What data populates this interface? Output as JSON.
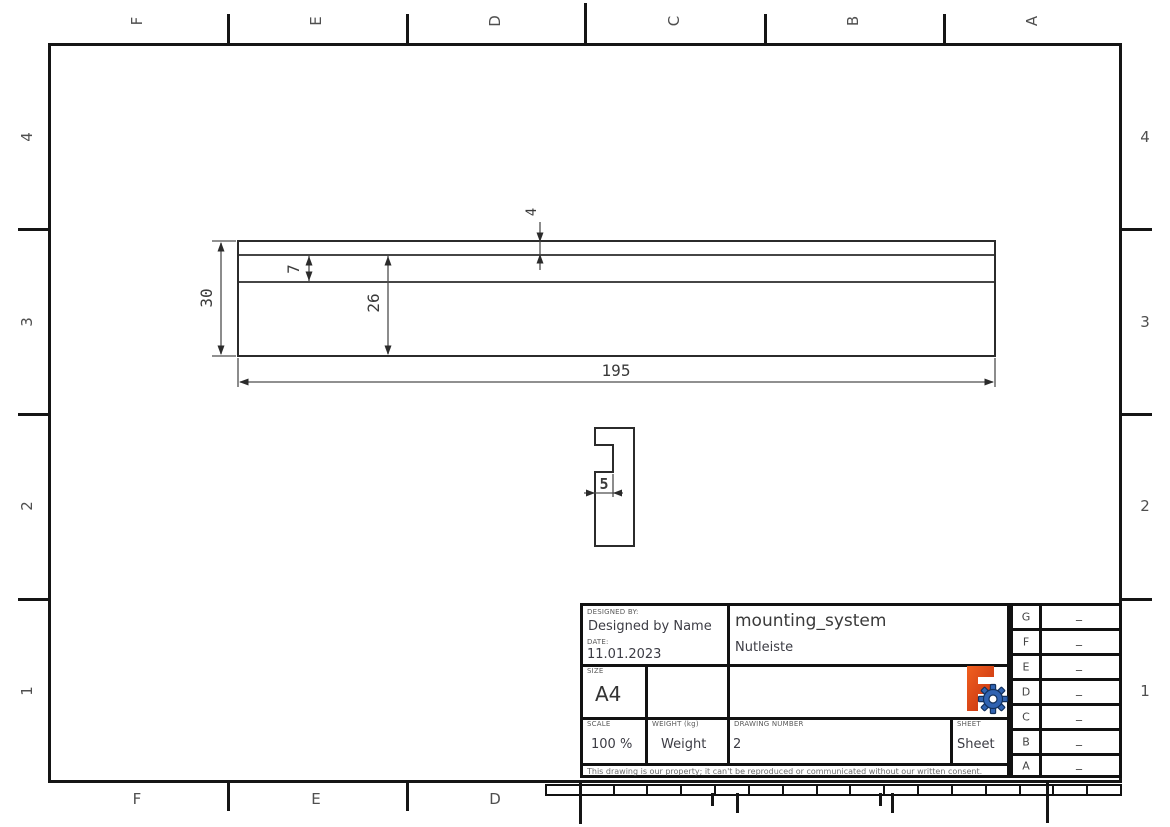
{
  "sheet": {
    "background": "#ffffff",
    "frame_color": "#151515",
    "format": "A4 landscape technical drawing"
  },
  "border": {
    "top_letters": [
      "F",
      "E",
      "D",
      "C",
      "B",
      "A"
    ],
    "bottom_letters": [
      "F",
      "E",
      "D"
    ],
    "left_numbers": [
      "4",
      "3",
      "2",
      "1"
    ],
    "right_numbers": [
      "4",
      "3",
      "2",
      "1"
    ]
  },
  "drawing": {
    "dims": {
      "length": "195",
      "total_height": "30",
      "inner_height": "26",
      "groove_height": "7",
      "top_lip": "4",
      "slot_width": "5"
    }
  },
  "title_block": {
    "designed_by_label": "DESIGNED BY:",
    "designed_by": "Designed by Name",
    "date_label": "DATE:",
    "date": "11.01.2023",
    "size_label": "SIZE",
    "size": "A4",
    "title": "mounting_system",
    "subtitle": "Nutleiste",
    "scale_label": "SCALE",
    "scale": "100 %",
    "weight_label": "WEIGHT (kg)",
    "weight": "Weight",
    "drawing_number_label": "DRAWING NUMBER",
    "drawing_number": "2",
    "sheet_label": "SHEET",
    "sheet": "Sheet",
    "disclaimer": "This drawing is our property; it can't be reproduced or communicated without our written consent.",
    "logo_colors": {
      "f_orange": "#e8481d",
      "f_red": "#c22f10",
      "gear_blue": "#3063b2",
      "gear_outline": "#12315e"
    }
  },
  "revision_table": {
    "rows": [
      {
        "letter": "G",
        "value": "_"
      },
      {
        "letter": "F",
        "value": "_"
      },
      {
        "letter": "E",
        "value": "_"
      },
      {
        "letter": "D",
        "value": "_"
      },
      {
        "letter": "C",
        "value": "_"
      },
      {
        "letter": "B",
        "value": "_"
      },
      {
        "letter": "A",
        "value": "_"
      }
    ]
  }
}
